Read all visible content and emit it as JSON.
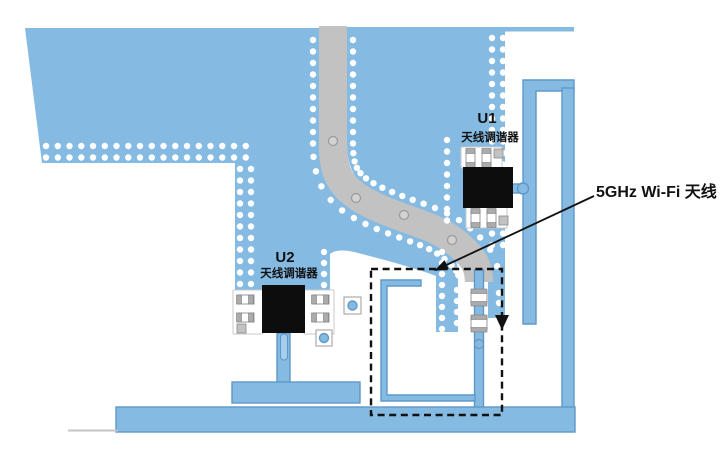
{
  "figure": {
    "components": [
      {
        "ref": "U1",
        "label": "天线调谐器"
      },
      {
        "ref": "U2",
        "label": "天线调谐器"
      }
    ],
    "callout_label": "5GHz Wi-Fi 天线"
  },
  "colors": {
    "copper": "#85BAE2",
    "copper_edge": "#5E98C8",
    "keepout_gray": "#C2C2C2",
    "trace_edge_gray": "#A8A8A8",
    "trace_center_gray": "#D2D2D2",
    "component_body_black": "#0D0D0D",
    "pad_cap_gray": "#ABABAB",
    "via_fill": "#FFFFFF",
    "annotation_black": "#111111",
    "board_edge_gray": "#C4C4C4",
    "background": "#FFFFFF"
  }
}
